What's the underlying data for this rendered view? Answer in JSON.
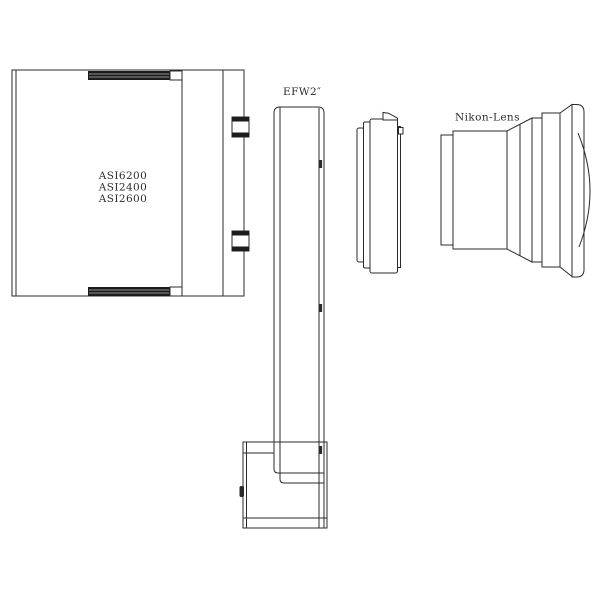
{
  "colors": {
    "line": "#2b2b2b",
    "strip": "#1c1c1c",
    "text": "#2b2b2b",
    "background": "#ffffff"
  },
  "diagram": {
    "camera": {
      "models": [
        "ASI6200",
        "ASI2400",
        "ASI2600"
      ]
    },
    "filter_wheel": {
      "label": "EFW2″"
    },
    "lens": {
      "label": "Nikon-Lens"
    }
  }
}
